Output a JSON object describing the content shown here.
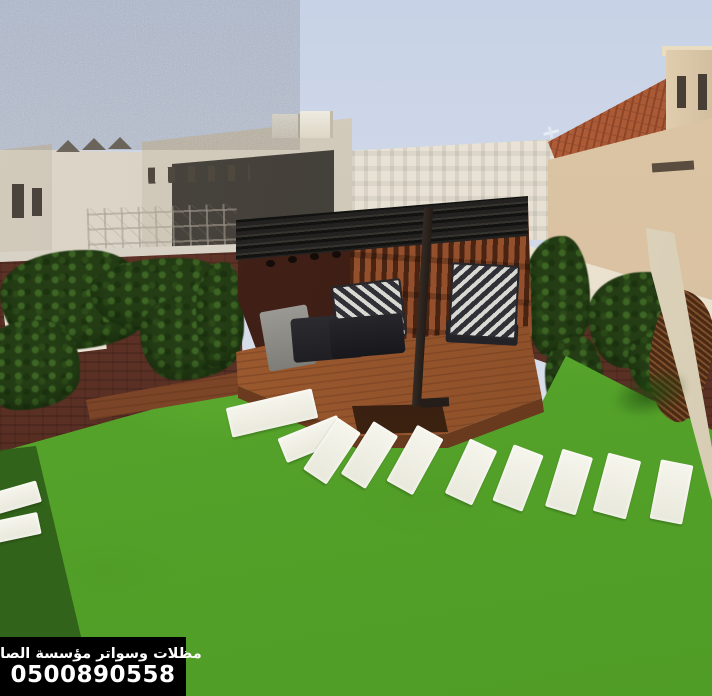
{
  "image": {
    "type": "photograph",
    "description": "Rooftop garden: black pergola over a wooden deck with striped cushions, artificial grass lawn with white stepping stones, ivy-covered brown walls, beige city buildings and a terracotta-roofed villa in the background, small airplane in the sky",
    "watermark": {
      "line1": "مظلات وسواتر مؤسسة الصالح",
      "line2": "0500890558"
    },
    "counts": {
      "stepping_stones": 11
    },
    "icons": {
      "airplane": "✈"
    },
    "colors": {
      "sky": "#ccd7e8",
      "grass": "#54a22a",
      "grass_shadow": "#2f5c18",
      "wall_brick": "#5a2f24",
      "ivy": "#243d15",
      "pergola_frame": "#232220",
      "wood_slats": "#94502c",
      "deck_wood": "#9a5a30",
      "stone": "#f3f2e8",
      "villa_roof": "#b25f37",
      "building_beige": "#d4ccbc",
      "caption_bg": "#000000",
      "caption_text": "#ffffff"
    }
  }
}
